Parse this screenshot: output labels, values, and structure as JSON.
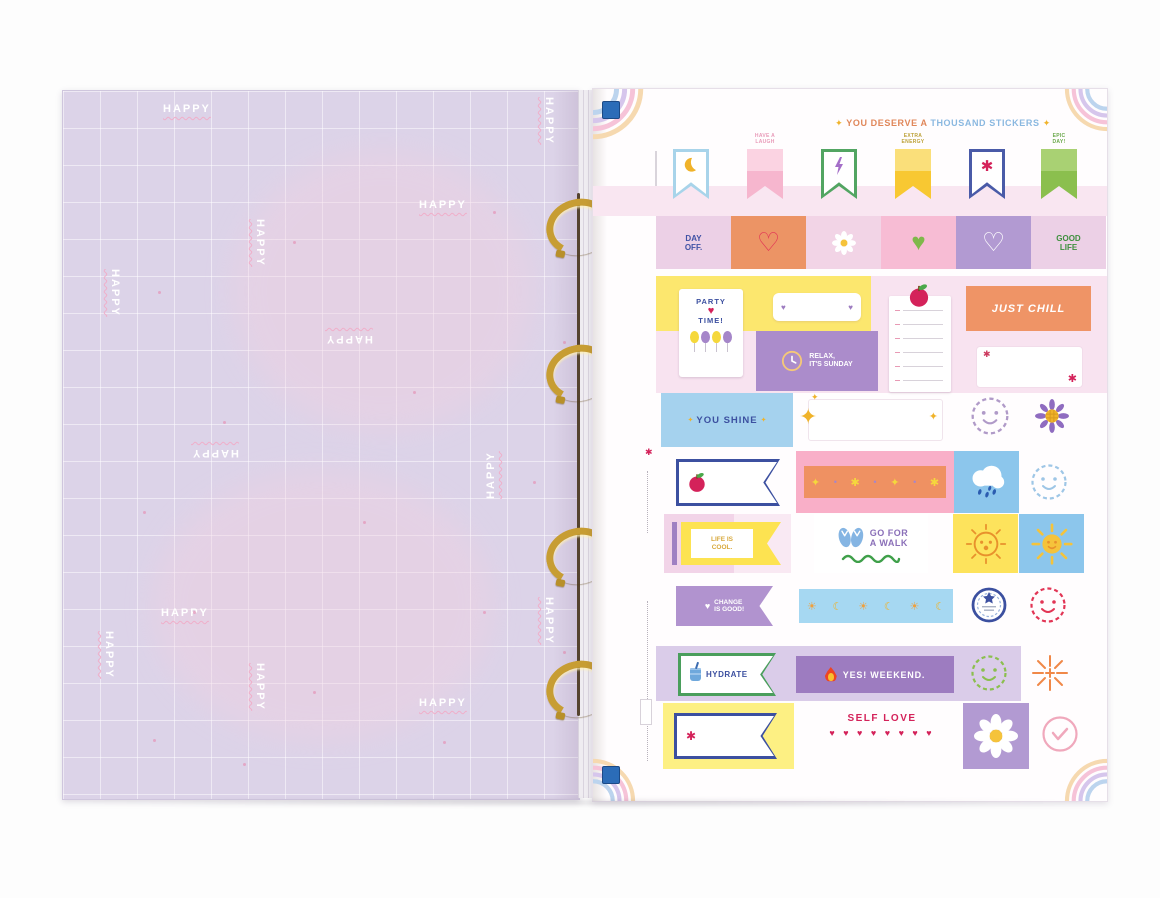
{
  "left_page": {
    "pattern_word": "HAPPY",
    "background_color": "#dcd3e8",
    "word_color": "#ffffff",
    "underline_color": "#f0aec9"
  },
  "binder": {
    "ring_count": 4,
    "ring_color": "#c79d33"
  },
  "right_page": {
    "title": {
      "star_left": "✦",
      "part1": "YOU DESERVE A",
      "part2": "THOUSAND STICKERS",
      "star_right": "✦",
      "part1_color": "#e0875a",
      "part2_color": "#8ab8e0"
    },
    "banner_labels": {
      "banner2": "HAVE A\nLAUGH",
      "banner4": "EXTRA\nENERGY",
      "banner6": "EPIC\nDAY!"
    },
    "square_strip": {
      "day_off": "DAY OFF.",
      "good_life": "GOOD LIFE"
    },
    "stickers": {
      "party_line1": "PARTY",
      "party_line2": "TIME!",
      "relax": "RELAX,\nIT'S SUNDAY",
      "just_chill": "JUST CHILL",
      "you_shine": "YOU SHINE",
      "life_cool": "LIFE IS\nCOOL.",
      "walk": "GO FOR\nA WALK",
      "change": "CHANGE\nIS GOOD!",
      "hydrate": "HYDRATE",
      "weekend": "YES! WEEKEND.",
      "self_love": "SELF LOVE",
      "hearts_row": "♥ ♥ ♥ ♥ ♥ ♥ ♥ ♥"
    },
    "strips": {
      "sparkle_row": [
        "✦",
        "•",
        "✱",
        "•",
        "✦",
        "•",
        "✱"
      ],
      "sun_moon_row": [
        "☀",
        "☾",
        "☀",
        "☾",
        "☀",
        "☾"
      ]
    },
    "glyphs": {
      "heart": "♥",
      "heart_outline": "♡",
      "sparkle": "✦",
      "flower": "✱",
      "sun": "☀",
      "moon": "☾",
      "dot": "•"
    },
    "colors": {
      "gold": "#f0b32a",
      "navy": "#3c50a0",
      "red": "#d4225a",
      "green": "#7fb84a",
      "orange": "#ef9466",
      "yellow": "#fce76e",
      "blue": "#a5d2ee",
      "purple": "#b29ad2",
      "pink": "#f7bcd4"
    }
  }
}
